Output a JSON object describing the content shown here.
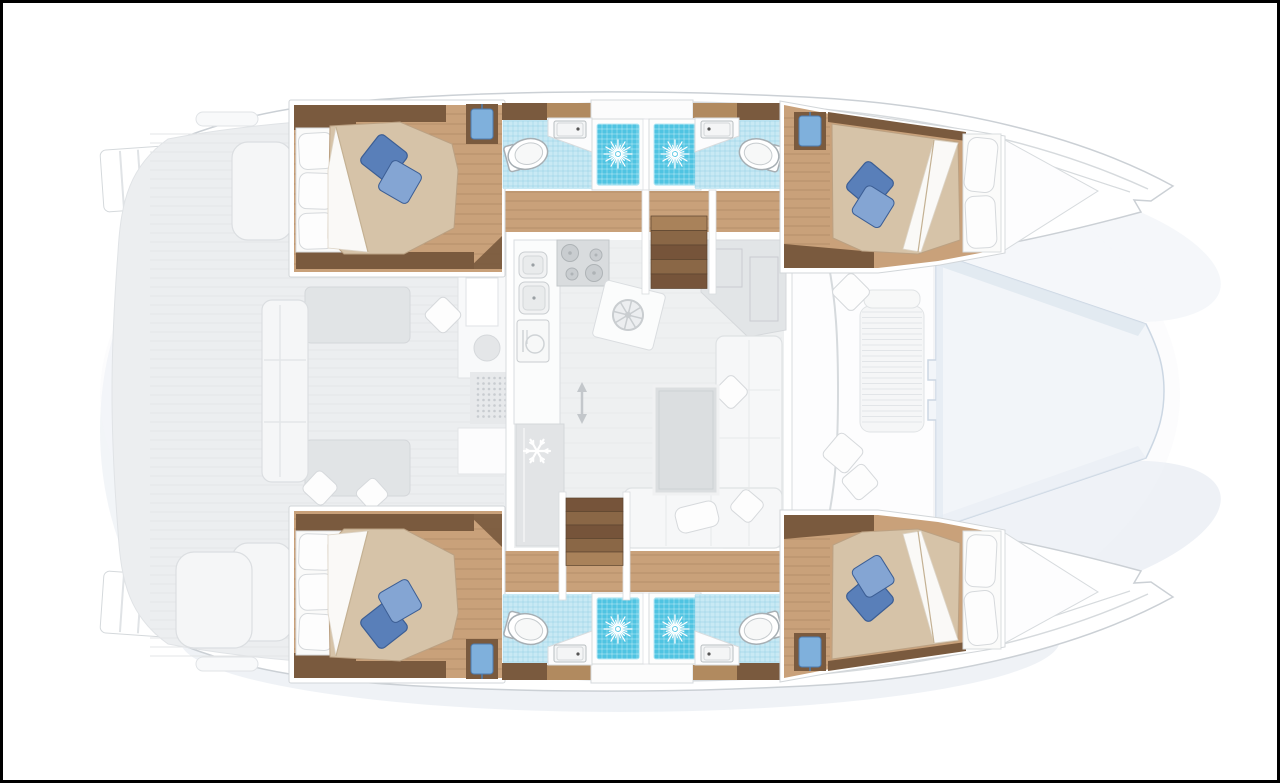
{
  "diagram": {
    "kind": "yacht-floor-plan",
    "vessel_type": "catamaran",
    "view": "top-down interior layout",
    "layout_version": "4 cabins / 4 bathrooms"
  },
  "palette": {
    "hullLine": "#cbd0d5",
    "deck": "#eceef0",
    "deckEdge": "#e0e3e6",
    "deckLine": "#e2e4e7",
    "wood": "#c9a17a",
    "woodMid": "#b18a5f",
    "woodDark": "#7a5a3e",
    "woodLine": "rgba(122,87,56,0.28)",
    "tile": "#c8e9f4",
    "tileLine": "rgba(125,195,220,0.45)",
    "shower": "#4fc4e2",
    "showerEdge": "#9adef0",
    "duvet": "#d6c3a8",
    "duvetEdge": "#bba183",
    "pillowBlue": "#597fb9",
    "pillowBlueLight": "#84a5d3",
    "pillowBlueDark": "#3c5e94",
    "towel": "#7fb0dc",
    "towelDark": "#4d7cb0",
    "furniture": "#f5f6f7",
    "furnitureLine": "#dbdee1",
    "saloonFloor": "#eef0f1",
    "saloonFloorLine": "#e8eaeb",
    "tread": "#8a6746",
    "treadLight": "#a9825a",
    "treadDark": "#76543a",
    "trampoline": "#f2f5f9",
    "trampolineEdge": "#ccd7e3",
    "shadow": "#c7d3e2",
    "frame": "#000000"
  },
  "rooms": {
    "cabins": [
      {
        "name": "aft cabin starboard",
        "bed": "island double bed",
        "pillows": "2 blue decorative pillows"
      },
      {
        "name": "forward cabin starboard",
        "bed": "double bed facing bow",
        "pillows": "2 blue decorative pillows"
      },
      {
        "name": "aft cabin port",
        "bed": "island double bed",
        "pillows": "2 blue decorative pillows"
      },
      {
        "name": "forward cabin port",
        "bed": "double bed facing bow",
        "pillows": "2 blue decorative pillows"
      }
    ],
    "bathrooms": [
      {
        "name": "aft bathroom starboard",
        "fixtures": [
          "toilet",
          "vanity sink",
          "shower"
        ]
      },
      {
        "name": "forward bathroom starboard",
        "fixtures": [
          "toilet",
          "vanity sink",
          "shower"
        ]
      },
      {
        "name": "aft bathroom port",
        "fixtures": [
          "toilet",
          "vanity sink",
          "shower"
        ]
      },
      {
        "name": "forward bathroom port",
        "fixtures": [
          "toilet",
          "vanity sink",
          "shower"
        ]
      }
    ],
    "saloon": {
      "name": "saloon and galley",
      "features": [
        "double sink",
        "four burner hob",
        "dishwasher",
        "refrigerator",
        "galley island",
        "navigation seat",
        "L-shaped sofa",
        "table",
        "two companionway stairs",
        "sliding door"
      ]
    },
    "cockpit": {
      "name": "aft cockpit",
      "features": [
        "aft bench",
        "side seats",
        "wet bar",
        "transom steps",
        "cleats"
      ]
    },
    "foredeck": {
      "name": "foredeck",
      "features": [
        "forward cockpit lounge",
        "trampoline"
      ]
    }
  },
  "icons": {
    "shower_drain": "starburst-icon",
    "refrigerator": "snowflake-icon",
    "galley_island": "wheel-icon",
    "sliding_door": "double-arrow-icon"
  }
}
